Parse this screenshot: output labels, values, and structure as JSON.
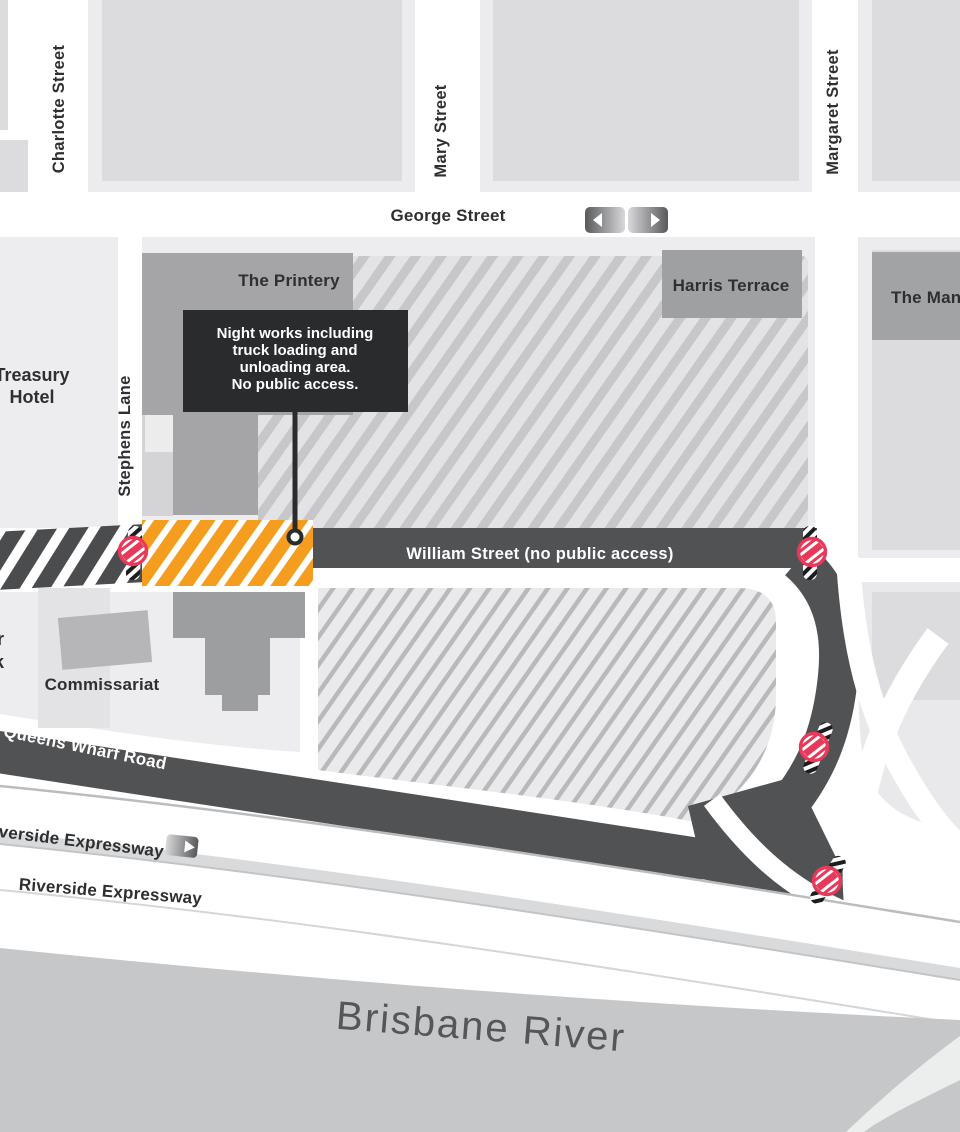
{
  "map_labels": {
    "charlotte_street": "Charlotte Street",
    "mary_street": "Mary Street",
    "margaret_street": "Margaret Street",
    "george_street": "George Street",
    "stephens_lane": "Stephens Lane",
    "william_street": "William Street (no public access)",
    "queens_wharf_road": "Queens Wharf Road",
    "riverside_expressway_upper": "Riverside Expressway",
    "riverside_expressway_lower": "Riverside Expressway",
    "brisbane_river": "Brisbane River"
  },
  "places": {
    "treasury_line1": "Treasury",
    "treasury_line2": "Hotel",
    "the_printery": "The Printery",
    "harris_terrace": "Harris Terrace",
    "the_mansions_clipped": "The Man",
    "commissariat": "Commissariat",
    "left_edge_fragment_top": "r",
    "left_edge_fragment_bottom": "k"
  },
  "callout": {
    "line1": "Night works including",
    "line2": "truck loading and",
    "line3": "unloading area.",
    "line4": "No public access."
  },
  "colors": {
    "work_zone_orange": "#F59D1E",
    "no_entry_red": "#E8395A",
    "road_dark_gray": "#515254",
    "closed_road_dark": "#4B4C4E",
    "callout_background": "#2A2B2D",
    "river_gray": "#C6C7C9",
    "building_gray": "#A2A3A5"
  },
  "icons": {
    "george_street_arrows": "two-way-traffic-icon",
    "riverside_expressway_arrow": "right-arrow-icon",
    "closure_sign": "no-entry-icon",
    "closure_barrier": "road-barrier-icon",
    "callout_marker": "location-marker-icon"
  }
}
